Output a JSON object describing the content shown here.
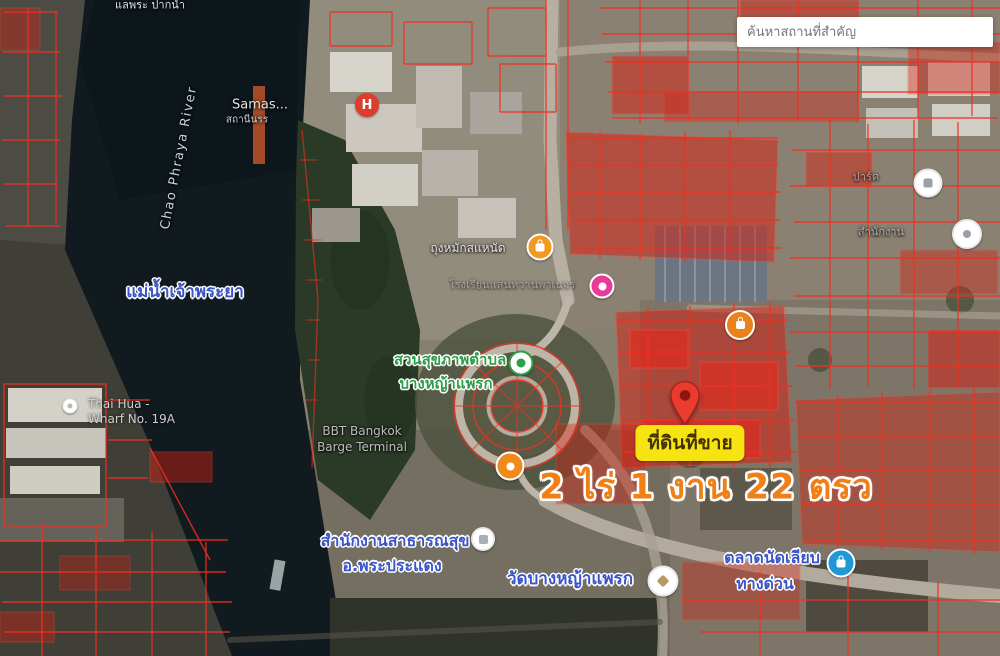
{
  "search": {
    "placeholder": "ค้นหาสถานที่สำคัญ"
  },
  "listing": {
    "sale_label": "ที่ดินที่ขาย",
    "area_text": "2 ไร่ 1 งาน 22 ตรว"
  },
  "labels": {
    "top_edge": "แลพระ ปากน้ำ",
    "pier_line1": "Samas...",
    "pier_line2": "สถานีนรร",
    "river_en": "Chao Phraya River",
    "river_th": "แม่น้ำเจ้าพระยา",
    "wharf_line1": "Thai Hua -",
    "wharf_line2": "Wharf No. 19A",
    "poi_north": "ถุงหมักสแหนัด",
    "school": "โรงเรียนแสนหวานพาเนจร",
    "park_line1": "สวนสุขภาพตำบล",
    "park_line2": "บางหญ้าแพรก",
    "terminal_line1": "BBT Bangkok",
    "terminal_line2": "Barge Terminal",
    "health_line1": "สำนักงานสาธารณสุข",
    "health_line2": "อ.พระประแดง",
    "temple": "วัดบางหญ้าแพรก",
    "market_line1": "ตลาดนัดเลียบ",
    "market_line2": "ทางด่วน",
    "faint_right_1": "ปาร์ค",
    "faint_right_2": "สำนักงาน"
  },
  "icons": {
    "hospital_glyph": "H"
  },
  "colors": {
    "parcel_red": "#f03022",
    "parcel_fill_red": "#d81f10",
    "pin_red": "#e93c2e",
    "sale_label_bg": "#f6e412",
    "area_text_orange": "#ef7f17",
    "poi_blue_label": "#3a55c8",
    "park_green": "#2f9e4a",
    "market_icon_blue": "#1f98d8",
    "hospital_red": "#dd3d2d",
    "poi_orange": "#f29a1f",
    "poi_pink": "#e73c96",
    "river_water": "#101a1f"
  }
}
